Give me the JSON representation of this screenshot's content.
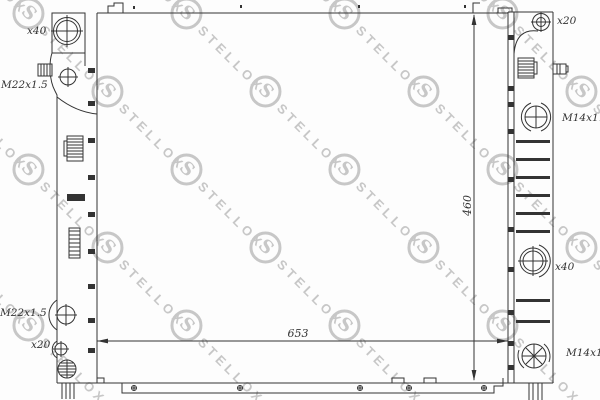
{
  "watermark": {
    "logo": "S",
    "text": "STELLOX"
  },
  "labels": {
    "left_top_diameter": "x40",
    "left_upper_thread": "M22x1.5",
    "left_lower_thread": "M22x1.5",
    "left_lower_diameter": "x20",
    "right_top_diameter": "x20",
    "right_upper_thread": "M14x1.5",
    "right_middle_diameter": "x40",
    "right_lower_thread": "M14x1.5"
  },
  "dimensions": {
    "width_mm": "653",
    "height_mm": "460"
  },
  "colors": {
    "line": "#333333",
    "watermark": "#c7c7c7",
    "background": "#fdfdfd"
  }
}
